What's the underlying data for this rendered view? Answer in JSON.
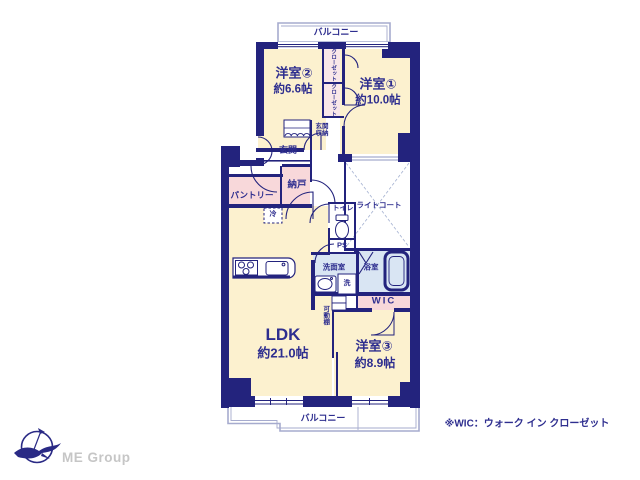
{
  "plan": {
    "labels": {
      "balcony_top": "バルコニー",
      "balcony_bottom": "バルコニー",
      "room2_name": "洋室②",
      "room2_size": "約6.6帖",
      "room1_name": "洋室①",
      "room1_size": "約10.0帖",
      "room3_name": "洋室③",
      "room3_size": "約8.9帖",
      "ldk_name": "LDK",
      "ldk_size": "約21.0帖",
      "closet_upper": "クローゼット",
      "closet_lower": "クローゼット",
      "genkan_storage": "玄関収納",
      "genkan": "玄関",
      "nando": "納戸",
      "pantry": "パントリー",
      "fridge": "冷",
      "toilet": "トイレ",
      "ps": "PS",
      "light_court": "ライトコート",
      "washroom": "洗面室",
      "washer": "洗",
      "bath": "浴室",
      "wic": "WIC",
      "movable_shelf": "可動棚"
    },
    "note": "※WIC：ウォーク イン クローゼット",
    "colors": {
      "wall_navy": "#23237d",
      "room_cream": "#fcf1cf",
      "storage_pink": "#f8d8da",
      "closet_pink": "#f9e7e9",
      "wet_blue": "#d9e5f3",
      "balcony_line": "#a6abce",
      "court_line": "#aab6d4",
      "text_navy": "#2e2e8f",
      "logo_gray": "#c6c6c6"
    }
  },
  "footer": {
    "logo_text": "ME Group"
  }
}
